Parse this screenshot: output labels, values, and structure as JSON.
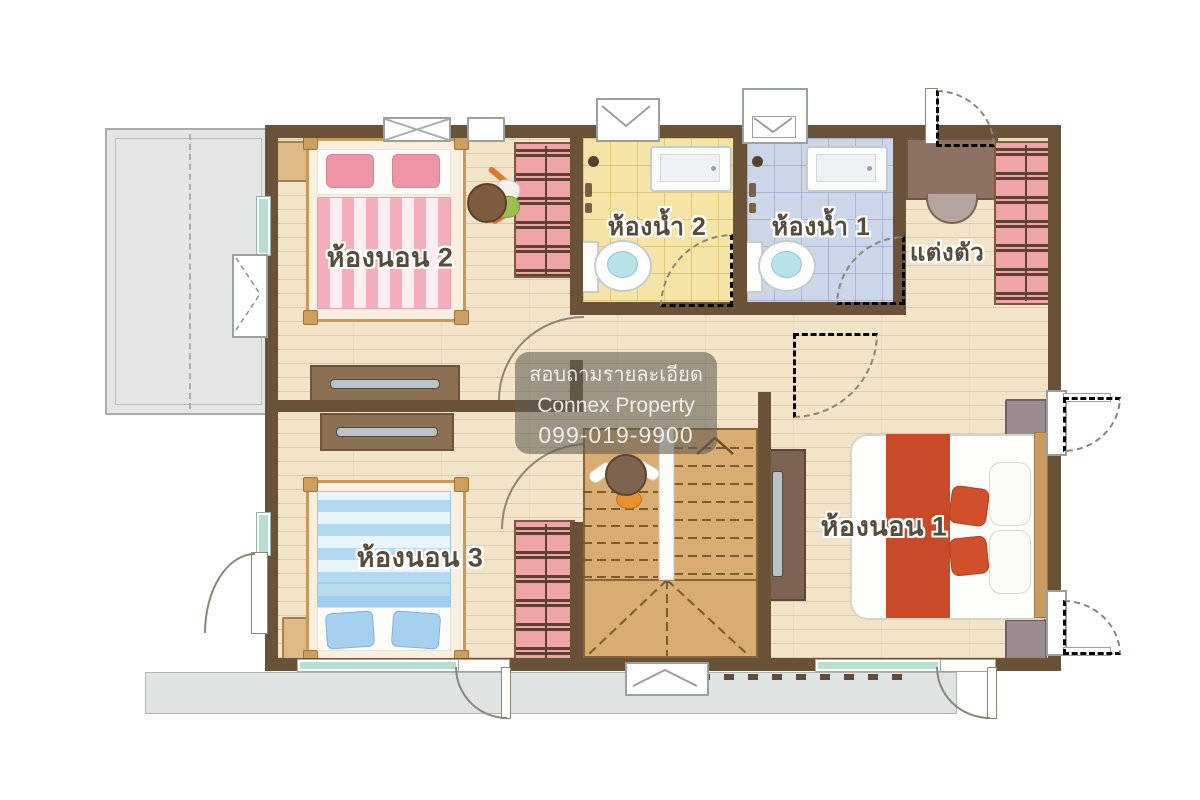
{
  "rooms": {
    "bedroom2": {
      "label": "ห้องนอน 2"
    },
    "bathroom2": {
      "label": "ห้องน้ำ 2"
    },
    "bathroom1": {
      "label": "ห้องน้ำ 1"
    },
    "dressing": {
      "label": "แต่งตัว"
    },
    "bedroom1": {
      "label": "ห้องนอน 1"
    },
    "bedroom3": {
      "label": "ห้องนอน 3"
    }
  },
  "watermark": {
    "line1": "สอบถามรายละเอียด",
    "line2": "Connex Property",
    "line3": "099-019-9900"
  },
  "colors": {
    "wall": "#6a5238",
    "floor": "#f3e3c9",
    "bath2": "#f4e5a6",
    "bath1": "#ccd6e9",
    "closet": "#efa4a8",
    "closet-bar": "#5f4134",
    "accent-red": "#c94a28",
    "bed-pink": "#f3aebc",
    "bed-blue": "#b3d9f1",
    "balcony": "#e3e6e3",
    "stair": "#d9ac72",
    "eave": "#dfe3e1"
  }
}
